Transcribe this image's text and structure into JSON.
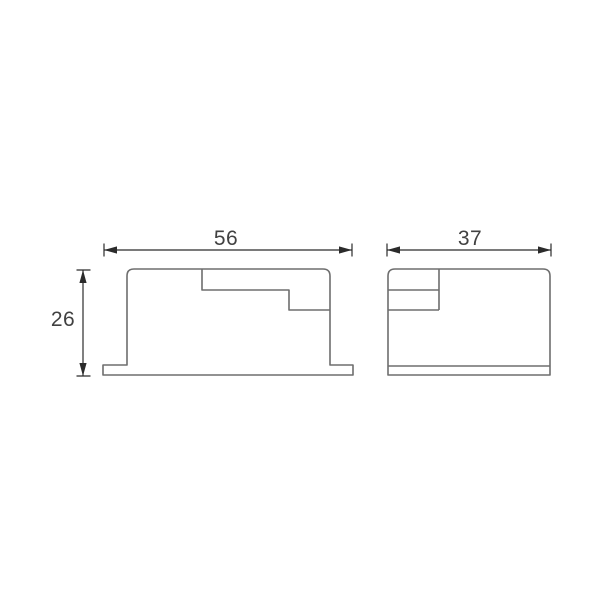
{
  "drawing": {
    "front_view": {
      "width_dim_label": "56",
      "height_dim_label": "26"
    },
    "side_view": {
      "width_dim_label": "37"
    },
    "colors": {
      "background": "#ffffff",
      "outline": "#6e6e6e",
      "dimension_line": "#2b2b2b",
      "dimension_text": "#414141"
    }
  }
}
